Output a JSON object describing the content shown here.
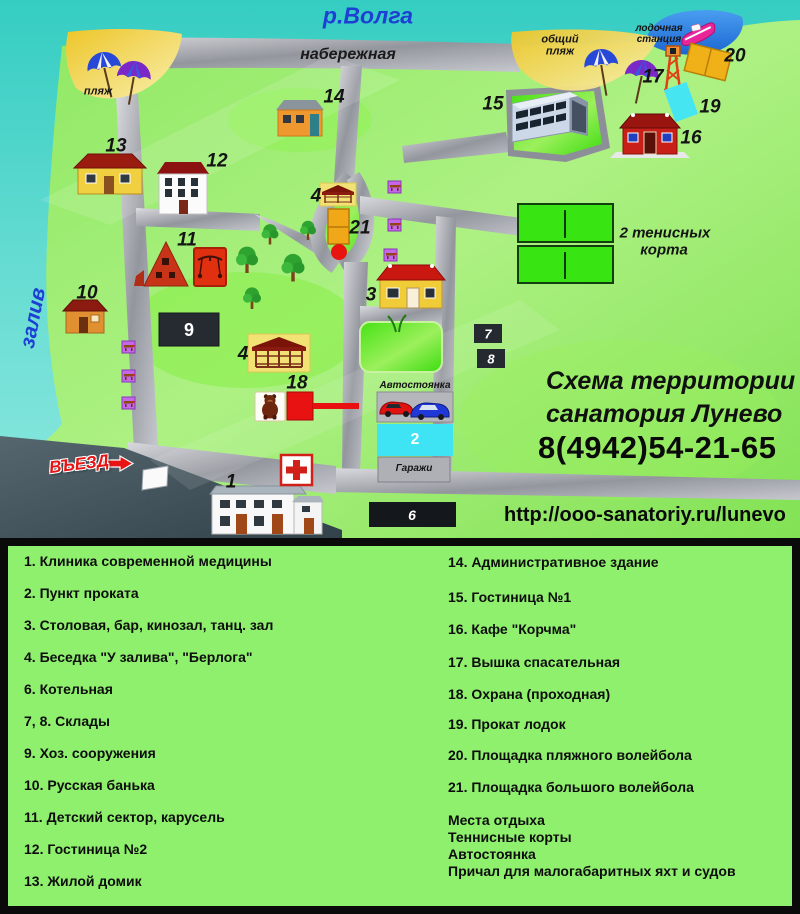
{
  "colors": {
    "water_teal": "#38cfc4",
    "bay_teal": "#7fe4da",
    "inlet_blue": "#1b66d2",
    "land_green": "#8ee862",
    "legend_green": "#8ef06d",
    "road_silver": "#a8aab2",
    "road_dark": "#46545a",
    "sand_yellow": "#f2cf3a",
    "court_green": "#38e412",
    "accent_red": "#e81212",
    "accent_cyan": "#3ee4f4",
    "accent_orange": "#f0a818",
    "label_blue": "#1d3fd4",
    "dark_box": "#262b31"
  },
  "map": {
    "river_label": "р.Волга",
    "embankment_label": "набережная",
    "bay_label": "залив",
    "beach_label": "пляж",
    "public_beach_line1": "общий",
    "public_beach_line2": "пляж",
    "boat_station_line1": "лодочная",
    "boat_station_line2": "станция",
    "tennis_line1": "2 тенисных",
    "tennis_line2": "корта",
    "entrance_label": "ВЪЕЗД",
    "parking_label": "Автостоянка",
    "garages_label": "Гаражи",
    "title_line1": "Схема территории",
    "title_line2": "санатория Лунево",
    "phone": "8(4942)54-21-65",
    "url": "http://ooo-sanatoriy.ru/lunevo",
    "numbers": {
      "b1": "1",
      "b2": "2",
      "b3": "3",
      "b4": "4",
      "b6": "6",
      "b7": "7",
      "b8": "8",
      "b9": "9",
      "b10": "10",
      "b11": "11",
      "b12": "12",
      "b13": "13",
      "b14": "14",
      "b15": "15",
      "b16": "16",
      "b17": "17",
      "b18": "18",
      "b19": "19",
      "b20": "20",
      "b21": "21"
    }
  },
  "legend": {
    "left": [
      "1. Клиника современной медицины",
      "2. Пункт проката",
      "3. Столовая, бар, кинозал, танц. зал",
      "4. Беседка  \"У залива\", \"Берлога\"",
      "6. Котельная",
      "7, 8. Склады",
      "9. Хоз. сооружения",
      "10. Русская банька",
      "11. Детский сектор, карусель",
      "12. Гостиница №2",
      "13. Жилой домик"
    ],
    "right": [
      "14. Административное здание",
      "15. Гостиница №1",
      "16. Кафе \"Корчма\"",
      "17. Вышка спасательная",
      "18. Охрана (проходная)",
      "19. Прокат лодок",
      "20. Площадка пляжного волейбола",
      "21. Площадка большого волейбола"
    ],
    "extras": [
      "Места отдыха",
      "Теннисные корты",
      "Автостоянка",
      "Причал для малогабаритных яхт и судов"
    ]
  }
}
